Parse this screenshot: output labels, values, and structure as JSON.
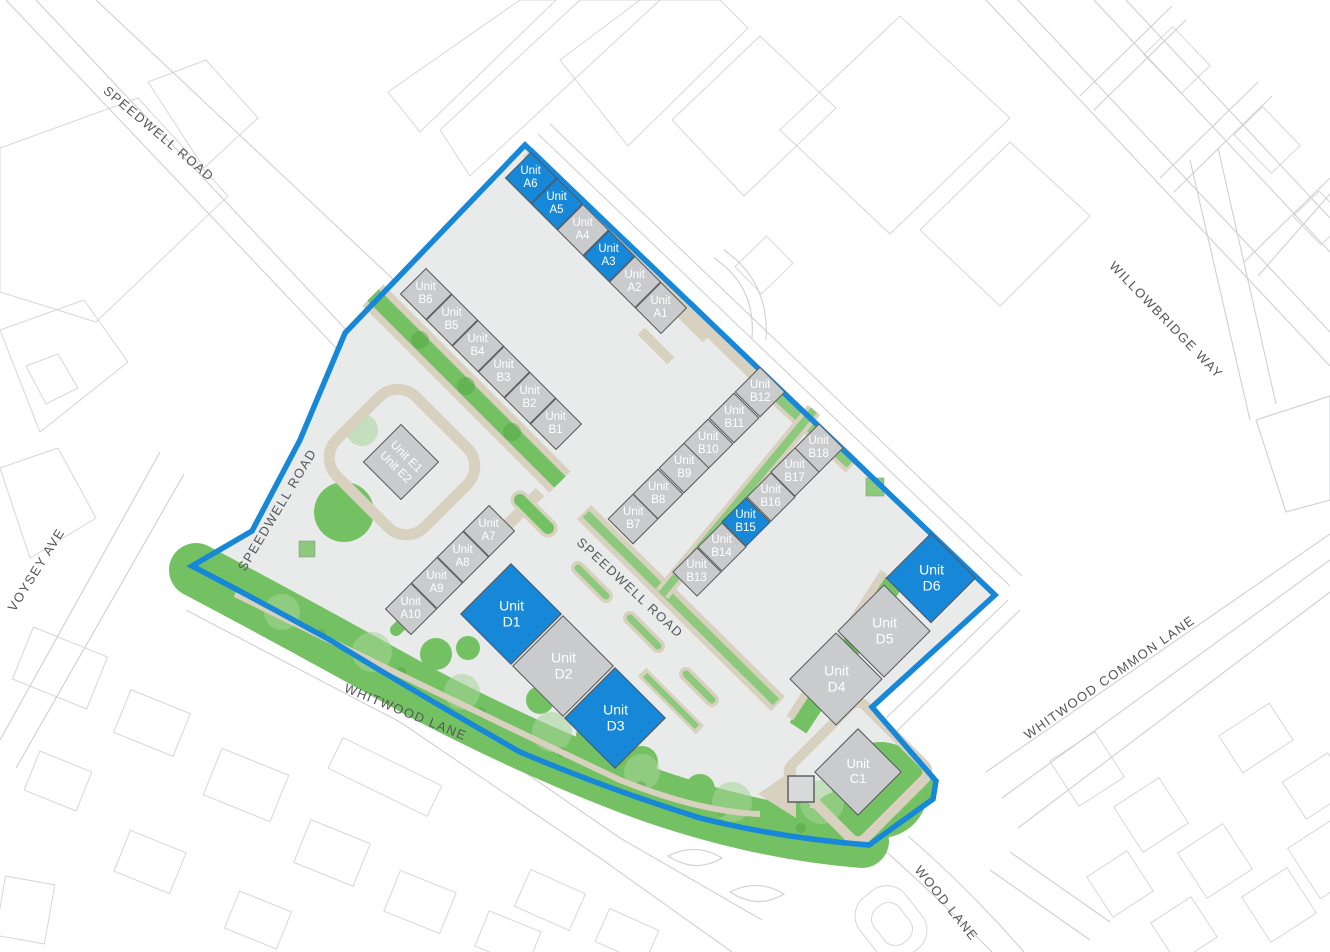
{
  "colors": {
    "boundary_blue": "#1787d8",
    "unit_available": "#1787d8",
    "unit_standard": "#c9cbcd",
    "unit_border": "#55565a",
    "ground": "#e9eaea",
    "green_main": "#74c163",
    "green_mid": "#8cc97c",
    "green_light": "#a6d598",
    "tree_dark": "#4f9f41",
    "path_beige": "#d9d1c0",
    "outline_gray": "#cfd0d1",
    "street_text": "#55565b",
    "unit_label": "#ffffff",
    "background": "#ffffff"
  },
  "streets": {
    "speedwell_nw": {
      "label": "SPEEDWELL ROAD"
    },
    "speedwell_west": {
      "label": "SPEEDWELL ROAD"
    },
    "speedwell_central": {
      "label": "SPEEDWELL ROAD"
    },
    "voysey_ave": {
      "label": "VOYSEY AVE"
    },
    "willowbridge_way": {
      "label": "WILLOWBRIDGE WAY"
    },
    "whitwood_common_lane": {
      "label": "WHITWOOD COMMON LANE"
    },
    "wood_lane": {
      "label": "WOOD LANE"
    },
    "whitwood_lane": {
      "label": "WHITWOOD LANE"
    }
  },
  "units": {
    "a1": {
      "label": "Unit\nA1",
      "status": "standard"
    },
    "a2": {
      "label": "Unit\nA2",
      "status": "standard"
    },
    "a3": {
      "label": "Unit\nA3",
      "status": "available"
    },
    "a4": {
      "label": "Unit\nA4",
      "status": "standard"
    },
    "a5": {
      "label": "Unit\nA5",
      "status": "available"
    },
    "a6": {
      "label": "Unit\nA6",
      "status": "available"
    },
    "a7": {
      "label": "Unit\nA7",
      "status": "standard"
    },
    "a8": {
      "label": "Unit\nA8",
      "status": "standard"
    },
    "a9": {
      "label": "Unit\nA9",
      "status": "standard"
    },
    "a10": {
      "label": "Unit\nA10",
      "status": "standard"
    },
    "b1": {
      "label": "Unit\nB1",
      "status": "standard"
    },
    "b2": {
      "label": "Unit\nB2",
      "status": "standard"
    },
    "b3": {
      "label": "Unit\nB3",
      "status": "standard"
    },
    "b4": {
      "label": "Unit\nB4",
      "status": "standard"
    },
    "b5": {
      "label": "Unit\nB5",
      "status": "standard"
    },
    "b6": {
      "label": "Unit\nB6",
      "status": "standard"
    },
    "b7": {
      "label": "Unit\nB7",
      "status": "standard"
    },
    "b8": {
      "label": "Unit\nB8",
      "status": "standard"
    },
    "b9": {
      "label": "Unit\nB9",
      "status": "standard"
    },
    "b10": {
      "label": "Unit\nB10",
      "status": "standard"
    },
    "b11": {
      "label": "Unit\nB11",
      "status": "standard"
    },
    "b12": {
      "label": "Unit\nB12",
      "status": "standard"
    },
    "b13": {
      "label": "Unit\nB13",
      "status": "standard"
    },
    "b14": {
      "label": "Unit\nB14",
      "status": "standard"
    },
    "b15": {
      "label": "Unit\nB15",
      "status": "available"
    },
    "b16": {
      "label": "Unit\nB16",
      "status": "standard"
    },
    "b17": {
      "label": "Unit\nB17",
      "status": "standard"
    },
    "b18": {
      "label": "Unit\nB18",
      "status": "standard"
    },
    "c1": {
      "label": "Unit\nC1",
      "status": "standard"
    },
    "d1": {
      "label": "Unit\nD1",
      "status": "available"
    },
    "d2": {
      "label": "Unit\nD2",
      "status": "standard"
    },
    "d3": {
      "label": "Unit\nD3",
      "status": "available"
    },
    "d4": {
      "label": "Unit\nD4",
      "status": "standard"
    },
    "d5": {
      "label": "Unit\nD5",
      "status": "standard"
    },
    "d6": {
      "label": "Unit\nD6",
      "status": "available"
    },
    "e1": {
      "label": "Unit E1",
      "status": "standard"
    },
    "e2": {
      "label": "Unit E2",
      "status": "standard"
    }
  }
}
